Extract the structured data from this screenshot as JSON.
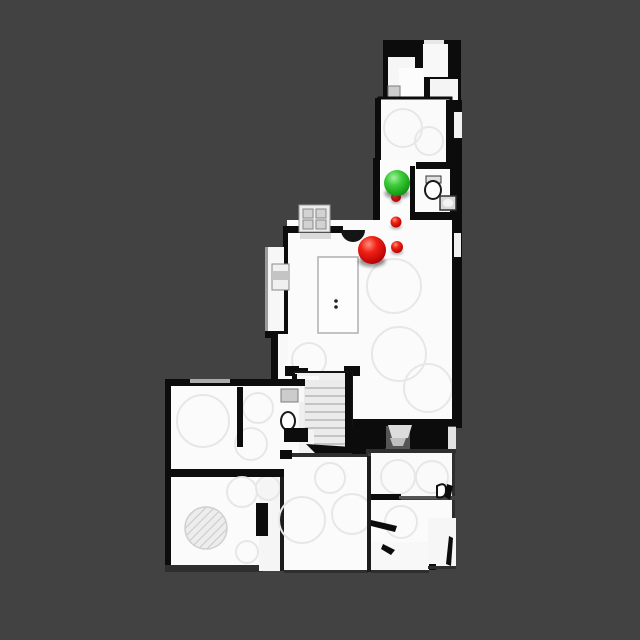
{
  "scene": {
    "description": "Top-down scanned floor plan (dollhouse view) on dark background with navigation sphere markers",
    "background_color": "#424242",
    "wall_color": "#0c0c0c",
    "floor_color": "#fbfbfb",
    "canvas": {
      "width": 640,
      "height": 640
    }
  },
  "markers": {
    "colors": {
      "green": "#2dbd2d",
      "red": "#e01010"
    },
    "items": [
      {
        "name": "waypoint-red-dot-upper",
        "shape": "sphere",
        "color": "red",
        "cx": 396,
        "cy": 197,
        "r": 5
      },
      {
        "name": "waypoint-red-dot-middle",
        "shape": "sphere",
        "color": "red",
        "cx": 396,
        "cy": 222,
        "r": 5.5
      },
      {
        "name": "waypoint-red-dot-lower",
        "shape": "sphere",
        "color": "red",
        "cx": 397,
        "cy": 247,
        "r": 6
      },
      {
        "name": "marker-red-sphere-large",
        "shape": "sphere",
        "color": "red",
        "cx": 372,
        "cy": 250,
        "r": 14
      },
      {
        "name": "marker-green-sphere",
        "shape": "sphere",
        "color": "green",
        "cx": 397,
        "cy": 183,
        "r": 13
      }
    ]
  }
}
